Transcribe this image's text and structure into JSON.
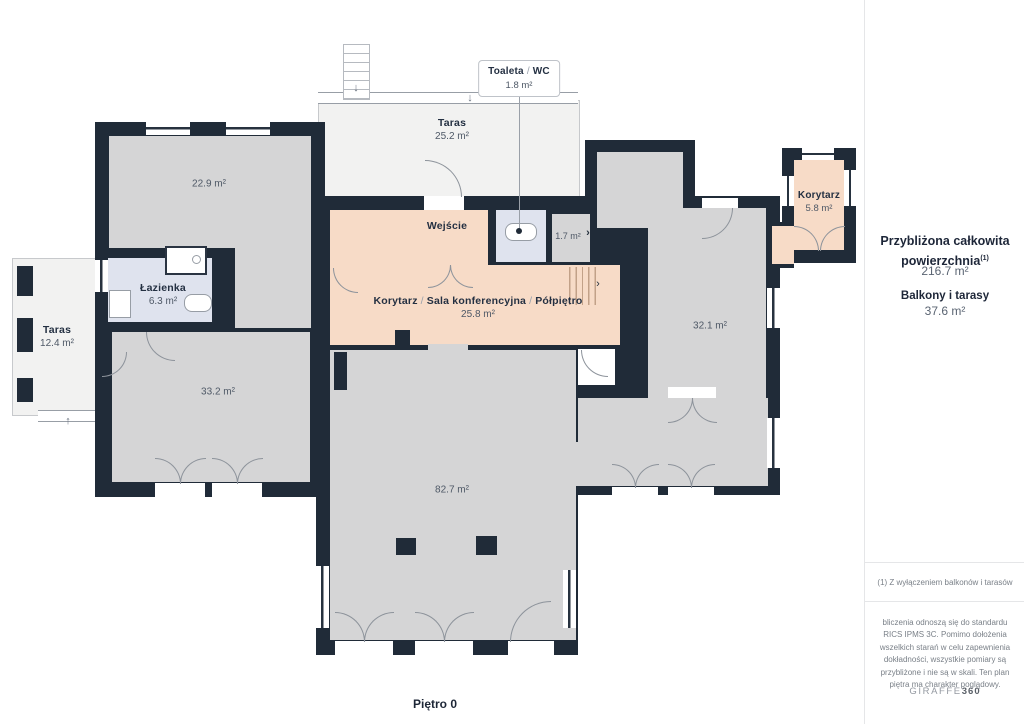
{
  "floorplan": {
    "floor_label": "Piętro 0",
    "callout": {
      "part1": "Toaleta",
      "sep": "/",
      "part2": "WC",
      "area": "1.8 m²"
    },
    "rooms": {
      "taras_top": {
        "name": "Taras",
        "area": "25.2 m²"
      },
      "room22": {
        "area": "22.9 m²"
      },
      "wejscie": {
        "name": "Wejście"
      },
      "room17": {
        "area": "1.7 m²"
      },
      "korytarz": {
        "name": "Korytarz",
        "area": "5.8 m²"
      },
      "lazienka": {
        "name": "Łazienka",
        "area": "6.3 m²"
      },
      "taras_left": {
        "name": "Taras",
        "area": "12.4 m²"
      },
      "main_hall": {
        "part1": "Korytarz",
        "part2": "Sala konferencyjna",
        "part3": "Półpiętro",
        "sep": "/",
        "area": "25.8 m²"
      },
      "room32": {
        "area": "32.1 m²"
      },
      "room33": {
        "area": "33.2 m²"
      },
      "room82": {
        "area": "82.7 m²"
      }
    },
    "icons": {
      "down_arrow": "↓",
      "up_arrow": "↑",
      "chevron": "›"
    }
  },
  "sidebar": {
    "total_title_line1": "Przybliżona całkowita",
    "total_title_line2": "powierzchnia",
    "total_title_sup": "(1)",
    "total_value": "216.7 m²",
    "balcony_title": "Balkony i tarasy",
    "balcony_value": "37.6 m²",
    "footnote": "(1) Z wyłączeniem balkonów i tarasów",
    "disclaimer": "bliczenia odnoszą się do standardu RICS IPMS 3C. Pomimo dołożenia wszelkich starań w celu zapewnienia dokładności, wszystkie pomiary są przybliżone i nie są w skali. Ten plan piętra ma charakter poglądowy.",
    "brand_name": "GIRAFFE",
    "brand_suffix": "360"
  },
  "colors": {
    "wall": "#202b38",
    "room_gray": "#d5d5d6",
    "room_peach": "#f7dbc7",
    "room_blue": "#dfe3ee",
    "terrace": "#f2f2f1"
  }
}
